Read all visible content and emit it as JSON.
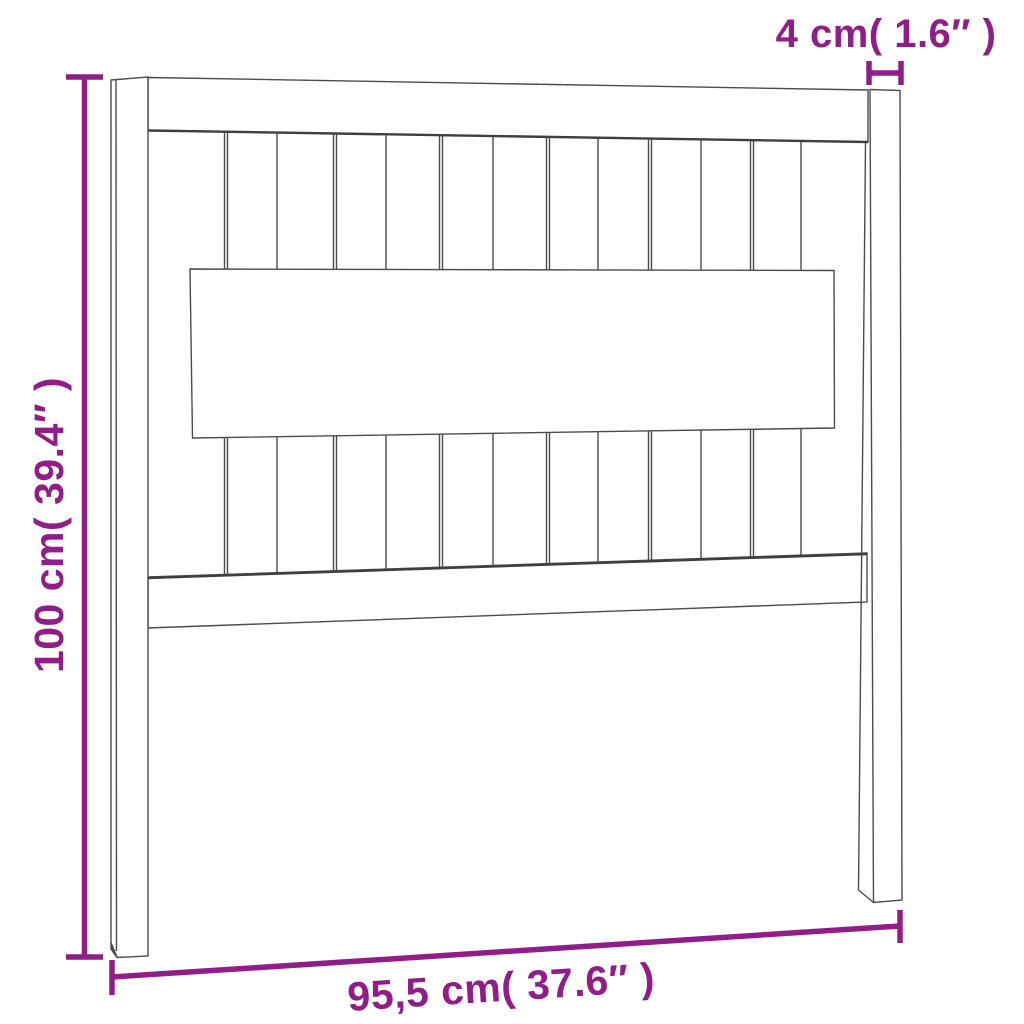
{
  "colors": {
    "accent": "#901D88",
    "line": "#4C4C4C",
    "background": "#FFFFFF"
  },
  "diagram": {
    "subject": "Slatted headboard dimension drawing",
    "dimensions": {
      "height_label": "100 cm( 39.4″ )",
      "width_label": "95,5 cm( 37.6″ )",
      "post_thickness_label": "4 cm( 1.6″ )"
    }
  }
}
